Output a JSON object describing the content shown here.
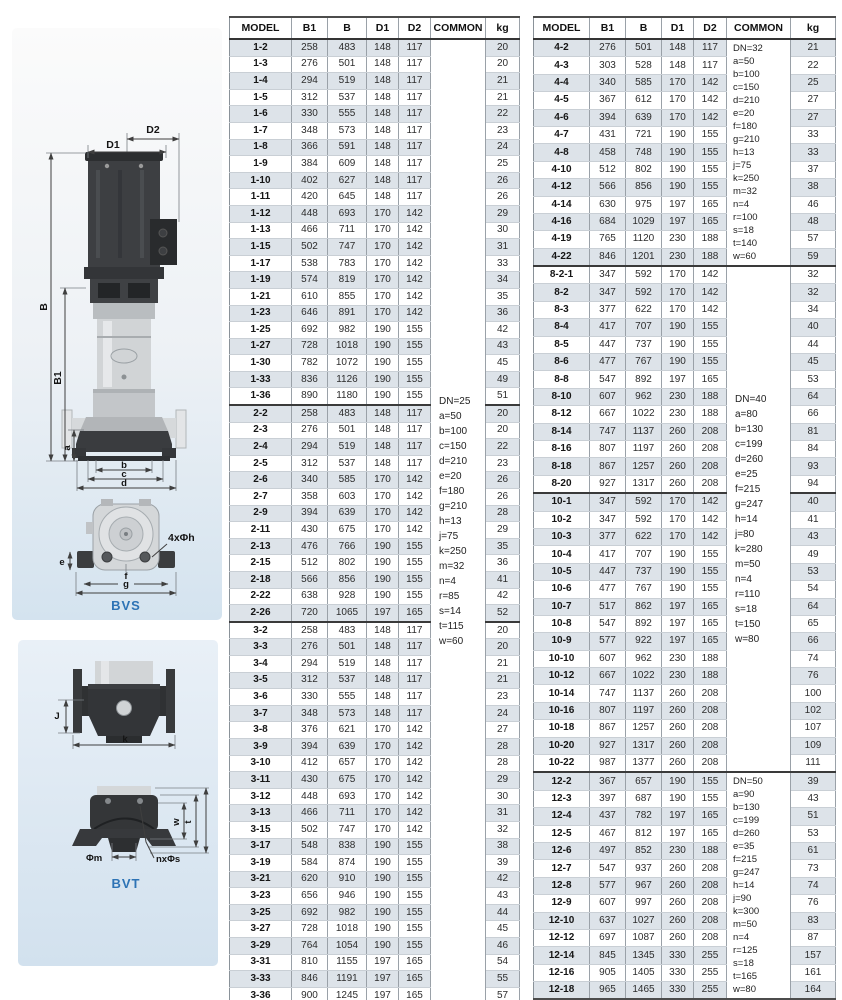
{
  "colors": {
    "accent_blue": "#2d73b5",
    "row_shade": "#dde3e9"
  },
  "drawings": {
    "labels": {
      "d1": "D1",
      "d2": "D2",
      "b_height": "B",
      "b1_height": "B1",
      "a": "a",
      "dim_b": "b",
      "dim_c": "c",
      "dim_d": "d",
      "bolt_holes": "4xΦh",
      "e": "e",
      "f": "f",
      "g": "g",
      "bvs": "BVS",
      "j": "J",
      "k": "k",
      "w": "w",
      "t": "t",
      "phi_m": "Φm",
      "n_phi_s": "nxΦs",
      "bvt": "BVT"
    }
  },
  "tables": {
    "headers": [
      "MODEL",
      "B1",
      "B",
      "D1",
      "D2",
      "COMMON",
      "kg"
    ],
    "left": {
      "sections": [
        {
          "rows": [
            [
              "1-2",
              258,
              483,
              148,
              117,
              20
            ],
            [
              "1-3",
              276,
              501,
              148,
              117,
              20
            ],
            [
              "1-4",
              294,
              519,
              148,
              117,
              21
            ],
            [
              "1-5",
              312,
              537,
              148,
              117,
              21
            ],
            [
              "1-6",
              330,
              555,
              148,
              117,
              22
            ],
            [
              "1-7",
              348,
              573,
              148,
              117,
              23
            ],
            [
              "1-8",
              366,
              591,
              148,
              117,
              24
            ],
            [
              "1-9",
              384,
              609,
              148,
              117,
              25
            ],
            [
              "1-10",
              402,
              627,
              148,
              117,
              26
            ],
            [
              "1-11",
              420,
              645,
              148,
              117,
              26
            ],
            [
              "1-12",
              448,
              693,
              170,
              142,
              29
            ],
            [
              "1-13",
              466,
              711,
              170,
              142,
              30
            ],
            [
              "1-15",
              502,
              747,
              170,
              142,
              31
            ],
            [
              "1-17",
              538,
              783,
              170,
              142,
              33
            ],
            [
              "1-19",
              574,
              819,
              170,
              142,
              34
            ],
            [
              "1-21",
              610,
              855,
              170,
              142,
              35
            ],
            [
              "1-23",
              646,
              891,
              170,
              142,
              36
            ],
            [
              "1-25",
              692,
              982,
              190,
              155,
              42
            ],
            [
              "1-27",
              728,
              1018,
              190,
              155,
              43
            ],
            [
              "1-30",
              782,
              1072,
              190,
              155,
              45
            ],
            [
              "1-33",
              836,
              1126,
              190,
              155,
              49
            ],
            [
              "1-36",
              890,
              1180,
              190,
              155,
              51
            ]
          ]
        },
        {
          "rows": [
            [
              "2-2",
              258,
              483,
              148,
              117,
              20
            ],
            [
              "2-3",
              276,
              501,
              148,
              117,
              20
            ],
            [
              "2-4",
              294,
              519,
              148,
              117,
              22
            ],
            [
              "2-5",
              312,
              537,
              148,
              117,
              23
            ],
            [
              "2-6",
              340,
              585,
              170,
              142,
              26
            ],
            [
              "2-7",
              358,
              603,
              170,
              142,
              26
            ],
            [
              "2-9",
              394,
              639,
              170,
              142,
              28
            ],
            [
              "2-11",
              430,
              675,
              170,
              142,
              29
            ],
            [
              "2-13",
              476,
              766,
              190,
              155,
              35
            ],
            [
              "2-15",
              512,
              802,
              190,
              155,
              36
            ],
            [
              "2-18",
              566,
              856,
              190,
              155,
              41
            ],
            [
              "2-22",
              638,
              928,
              190,
              155,
              42
            ],
            [
              "2-26",
              720,
              1065,
              197,
              165,
              52
            ]
          ]
        },
        {
          "rows": [
            [
              "3-2",
              258,
              483,
              148,
              117,
              20
            ],
            [
              "3-3",
              276,
              501,
              148,
              117,
              20
            ],
            [
              "3-4",
              294,
              519,
              148,
              117,
              21
            ],
            [
              "3-5",
              312,
              537,
              148,
              117,
              21
            ],
            [
              "3-6",
              330,
              555,
              148,
              117,
              23
            ],
            [
              "3-7",
              348,
              573,
              148,
              117,
              24
            ],
            [
              "3-8",
              376,
              621,
              170,
              142,
              27
            ],
            [
              "3-9",
              394,
              639,
              170,
              142,
              28
            ],
            [
              "3-10",
              412,
              657,
              170,
              142,
              28
            ],
            [
              "3-11",
              430,
              675,
              170,
              142,
              29
            ],
            [
              "3-12",
              448,
              693,
              170,
              142,
              30
            ],
            [
              "3-13",
              466,
              711,
              170,
              142,
              31
            ],
            [
              "3-15",
              502,
              747,
              170,
              142,
              32
            ],
            [
              "3-17",
              548,
              838,
              190,
              155,
              38
            ],
            [
              "3-19",
              584,
              874,
              190,
              155,
              39
            ],
            [
              "3-21",
              620,
              910,
              190,
              155,
              42
            ],
            [
              "3-23",
              656,
              946,
              190,
              155,
              43
            ],
            [
              "3-25",
              692,
              982,
              190,
              155,
              44
            ],
            [
              "3-27",
              728,
              1018,
              190,
              155,
              45
            ],
            [
              "3-29",
              764,
              1054,
              190,
              155,
              46
            ],
            [
              "3-31",
              810,
              1155,
              197,
              165,
              54
            ],
            [
              "3-33",
              846,
              1191,
              197,
              165,
              55
            ],
            [
              "3-36",
              900,
              1245,
              197,
              165,
              57
            ]
          ]
        }
      ],
      "common": [
        {
          "section": 0,
          "span": [
            0,
            1,
            2
          ],
          "tight": false,
          "lines": [
            "DN=25",
            "a=50",
            "b=100",
            "c=150",
            "d=210",
            "e=20",
            "f=180",
            "g=210",
            "h=13",
            "j=75",
            "k=250",
            "m=32",
            "n=4",
            "r=85",
            "s=14",
            "t=115",
            "w=60"
          ]
        }
      ]
    },
    "right": {
      "sections": [
        {
          "rows": [
            [
              "4-2",
              276,
              501,
              148,
              117,
              21
            ],
            [
              "4-3",
              303,
              528,
              148,
              117,
              22
            ],
            [
              "4-4",
              340,
              585,
              170,
              142,
              25
            ],
            [
              "4-5",
              367,
              612,
              170,
              142,
              27
            ],
            [
              "4-6",
              394,
              639,
              170,
              142,
              27
            ],
            [
              "4-7",
              431,
              721,
              190,
              155,
              33
            ],
            [
              "4-8",
              458,
              748,
              190,
              155,
              33
            ],
            [
              "4-10",
              512,
              802,
              190,
              155,
              37
            ],
            [
              "4-12",
              566,
              856,
              190,
              155,
              38
            ],
            [
              "4-14",
              630,
              975,
              197,
              165,
              46
            ],
            [
              "4-16",
              684,
              1029,
              197,
              165,
              48
            ],
            [
              "4-19",
              765,
              1120,
              230,
              188,
              57
            ],
            [
              "4-22",
              846,
              1201,
              230,
              188,
              59
            ]
          ]
        },
        {
          "rows": [
            [
              "8-2-1",
              347,
              592,
              170,
              142,
              32
            ],
            [
              "8-2",
              347,
              592,
              170,
              142,
              32
            ],
            [
              "8-3",
              377,
              622,
              170,
              142,
              34
            ],
            [
              "8-4",
              417,
              707,
              190,
              155,
              40
            ],
            [
              "8-5",
              447,
              737,
              190,
              155,
              44
            ],
            [
              "8-6",
              477,
              767,
              190,
              155,
              45
            ],
            [
              "8-8",
              547,
              892,
              197,
              165,
              53
            ],
            [
              "8-10",
              607,
              962,
              230,
              188,
              64
            ],
            [
              "8-12",
              667,
              1022,
              230,
              188,
              66
            ],
            [
              "8-14",
              747,
              1137,
              260,
              208,
              81
            ],
            [
              "8-16",
              807,
              1197,
              260,
              208,
              84
            ],
            [
              "8-18",
              867,
              1257,
              260,
              208,
              93
            ],
            [
              "8-20",
              927,
              1317,
              260,
              208,
              94
            ]
          ]
        },
        {
          "rows": [
            [
              "10-1",
              347,
              592,
              170,
              142,
              40
            ],
            [
              "10-2",
              347,
              592,
              170,
              142,
              41
            ],
            [
              "10-3",
              377,
              622,
              170,
              142,
              43
            ],
            [
              "10-4",
              417,
              707,
              190,
              155,
              49
            ],
            [
              "10-5",
              447,
              737,
              190,
              155,
              53
            ],
            [
              "10-6",
              477,
              767,
              190,
              155,
              54
            ],
            [
              "10-7",
              517,
              862,
              197,
              165,
              64
            ],
            [
              "10-8",
              547,
              892,
              197,
              165,
              65
            ],
            [
              "10-9",
              577,
              922,
              197,
              165,
              66
            ],
            [
              "10-10",
              607,
              962,
              230,
              188,
              74
            ],
            [
              "10-12",
              667,
              1022,
              230,
              188,
              76
            ],
            [
              "10-14",
              747,
              1137,
              260,
              208,
              100
            ],
            [
              "10-16",
              807,
              1197,
              260,
              208,
              102
            ],
            [
              "10-18",
              867,
              1257,
              260,
              208,
              107
            ],
            [
              "10-20",
              927,
              1317,
              260,
              208,
              109
            ],
            [
              "10-22",
              987,
              1377,
              260,
              208,
              111
            ]
          ]
        },
        {
          "rows": [
            [
              "12-2",
              367,
              657,
              190,
              155,
              39
            ],
            [
              "12-3",
              397,
              687,
              190,
              155,
              43
            ],
            [
              "12-4",
              437,
              782,
              197,
              165,
              51
            ],
            [
              "12-5",
              467,
              812,
              197,
              165,
              53
            ],
            [
              "12-6",
              497,
              852,
              230,
              188,
              61
            ],
            [
              "12-7",
              547,
              937,
              260,
              208,
              73
            ],
            [
              "12-8",
              577,
              967,
              260,
              208,
              74
            ],
            [
              "12-9",
              607,
              997,
              260,
              208,
              76
            ],
            [
              "12-10",
              637,
              1027,
              260,
              208,
              83
            ],
            [
              "12-12",
              697,
              1087,
              260,
              208,
              87
            ],
            [
              "12-14",
              845,
              1345,
              330,
              255,
              157
            ],
            [
              "12-16",
              905,
              1405,
              330,
              255,
              161
            ],
            [
              "12-18",
              965,
              1465,
              330,
              255,
              164
            ]
          ]
        }
      ],
      "common": [
        {
          "section": 0,
          "span": [
            0
          ],
          "tight": true,
          "lines": [
            "DN=32",
            "a=50",
            "b=100",
            "c=150",
            "d=210",
            "e=20",
            "f=180",
            "g=210",
            "h=13",
            "j=75",
            "k=250",
            "m=32",
            "n=4",
            "r=100",
            "s=18",
            "t=140",
            "w=60"
          ]
        },
        {
          "section": 1,
          "span": [
            1,
            2
          ],
          "tight": false,
          "lines": [
            "DN=40",
            "a=80",
            "b=130",
            "c=199",
            "d=260",
            "e=25",
            "f=215",
            "g=247",
            "h=14",
            "j=80",
            "k=280",
            "m=50",
            "n=4",
            "r=110",
            "s=18",
            "t=150",
            "w=80"
          ]
        },
        {
          "section": 3,
          "span": [
            3
          ],
          "tight": true,
          "lines": [
            "DN=50",
            "a=90",
            "b=130",
            "c=199",
            "d=260",
            "e=35",
            "f=215",
            "g=247",
            "h=14",
            "j=90",
            "k=300",
            "m=50",
            "n=4",
            "r=125",
            "s=18",
            "t=165",
            "w=80"
          ]
        }
      ]
    }
  }
}
